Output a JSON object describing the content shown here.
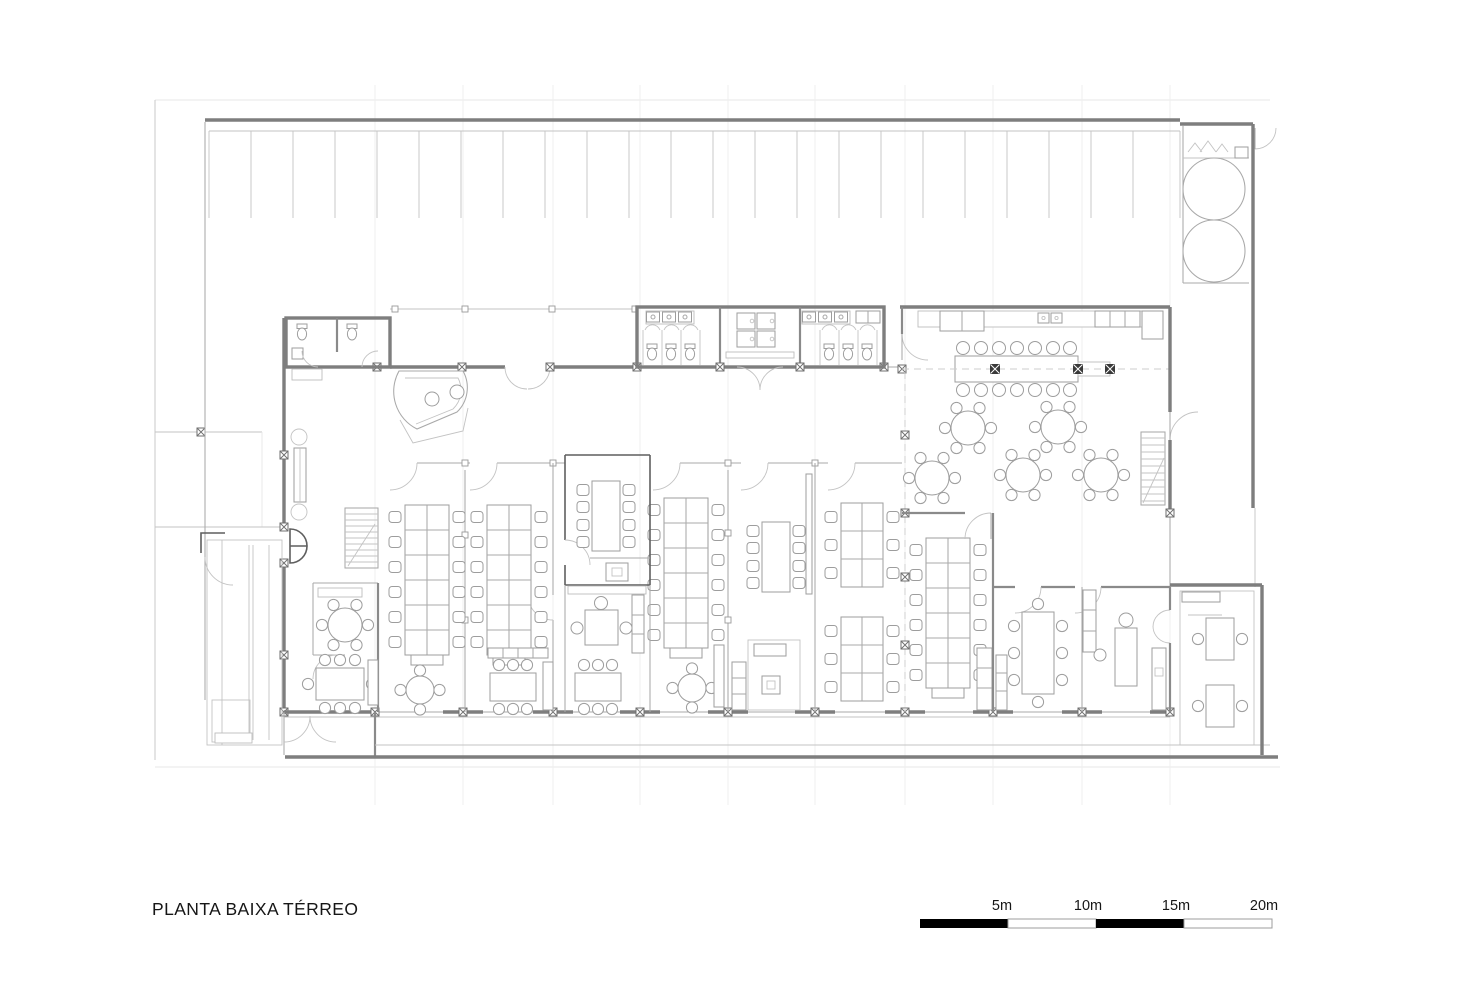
{
  "title": {
    "text": "PLANTA BAIXA TÉRREO"
  },
  "scale_bar": {
    "labels": [
      "5m",
      "10m",
      "15m",
      "20m"
    ],
    "segment_meters": 5,
    "total_meters": 20,
    "colors": {
      "filled": "#000000",
      "empty": "#ffffff",
      "border": "#9c9c9c"
    }
  },
  "drawing": {
    "type": "architectural-floor-plan",
    "wall_color": "#7e7e7e",
    "line_color": "#a9a9a9",
    "background": "#ffffff",
    "areas": [
      {
        "id": "parking",
        "label": "parking row",
        "stalls": 23
      },
      {
        "id": "water-tank-room",
        "label": "tank room",
        "tanks": 2
      },
      {
        "id": "wc-block",
        "label": "entrance WCs",
        "rooms": 2
      },
      {
        "id": "reception",
        "label": "reception desk",
        "chairs": 2
      },
      {
        "id": "restrooms",
        "label": "central restrooms",
        "stalls_each": 3,
        "sinks_each": 3
      },
      {
        "id": "locker-area",
        "label": "lockers between restrooms",
        "lockers": 4
      },
      {
        "id": "cafeteria",
        "label": "cafeteria",
        "round_tables": 5,
        "round_table_seats": 6,
        "long_table_seats": 14
      },
      {
        "id": "open-office",
        "label": "open office bays",
        "desk_benches": 5,
        "desk_clusters": 2
      },
      {
        "id": "central-meeting-room",
        "label": "meeting room",
        "seats": 8
      },
      {
        "id": "lounge",
        "label": "lounge with sofa and rug"
      },
      {
        "id": "small-meeting-tables",
        "label": "small meeting tables",
        "count": 4
      },
      {
        "id": "left-meeting-room",
        "label": "left meeting room",
        "seats": 8
      },
      {
        "id": "right-meeting-room",
        "label": "right meeting room",
        "seats": 8
      },
      {
        "id": "right-office",
        "label": "private office"
      },
      {
        "id": "corner-office",
        "label": "corner room",
        "tables": 2
      },
      {
        "id": "stairs",
        "label": "staircases",
        "count": 2
      },
      {
        "id": "ramp",
        "label": "service ramp / loading strip"
      },
      {
        "id": "sidewalk",
        "label": "sidewalk edge"
      }
    ]
  }
}
